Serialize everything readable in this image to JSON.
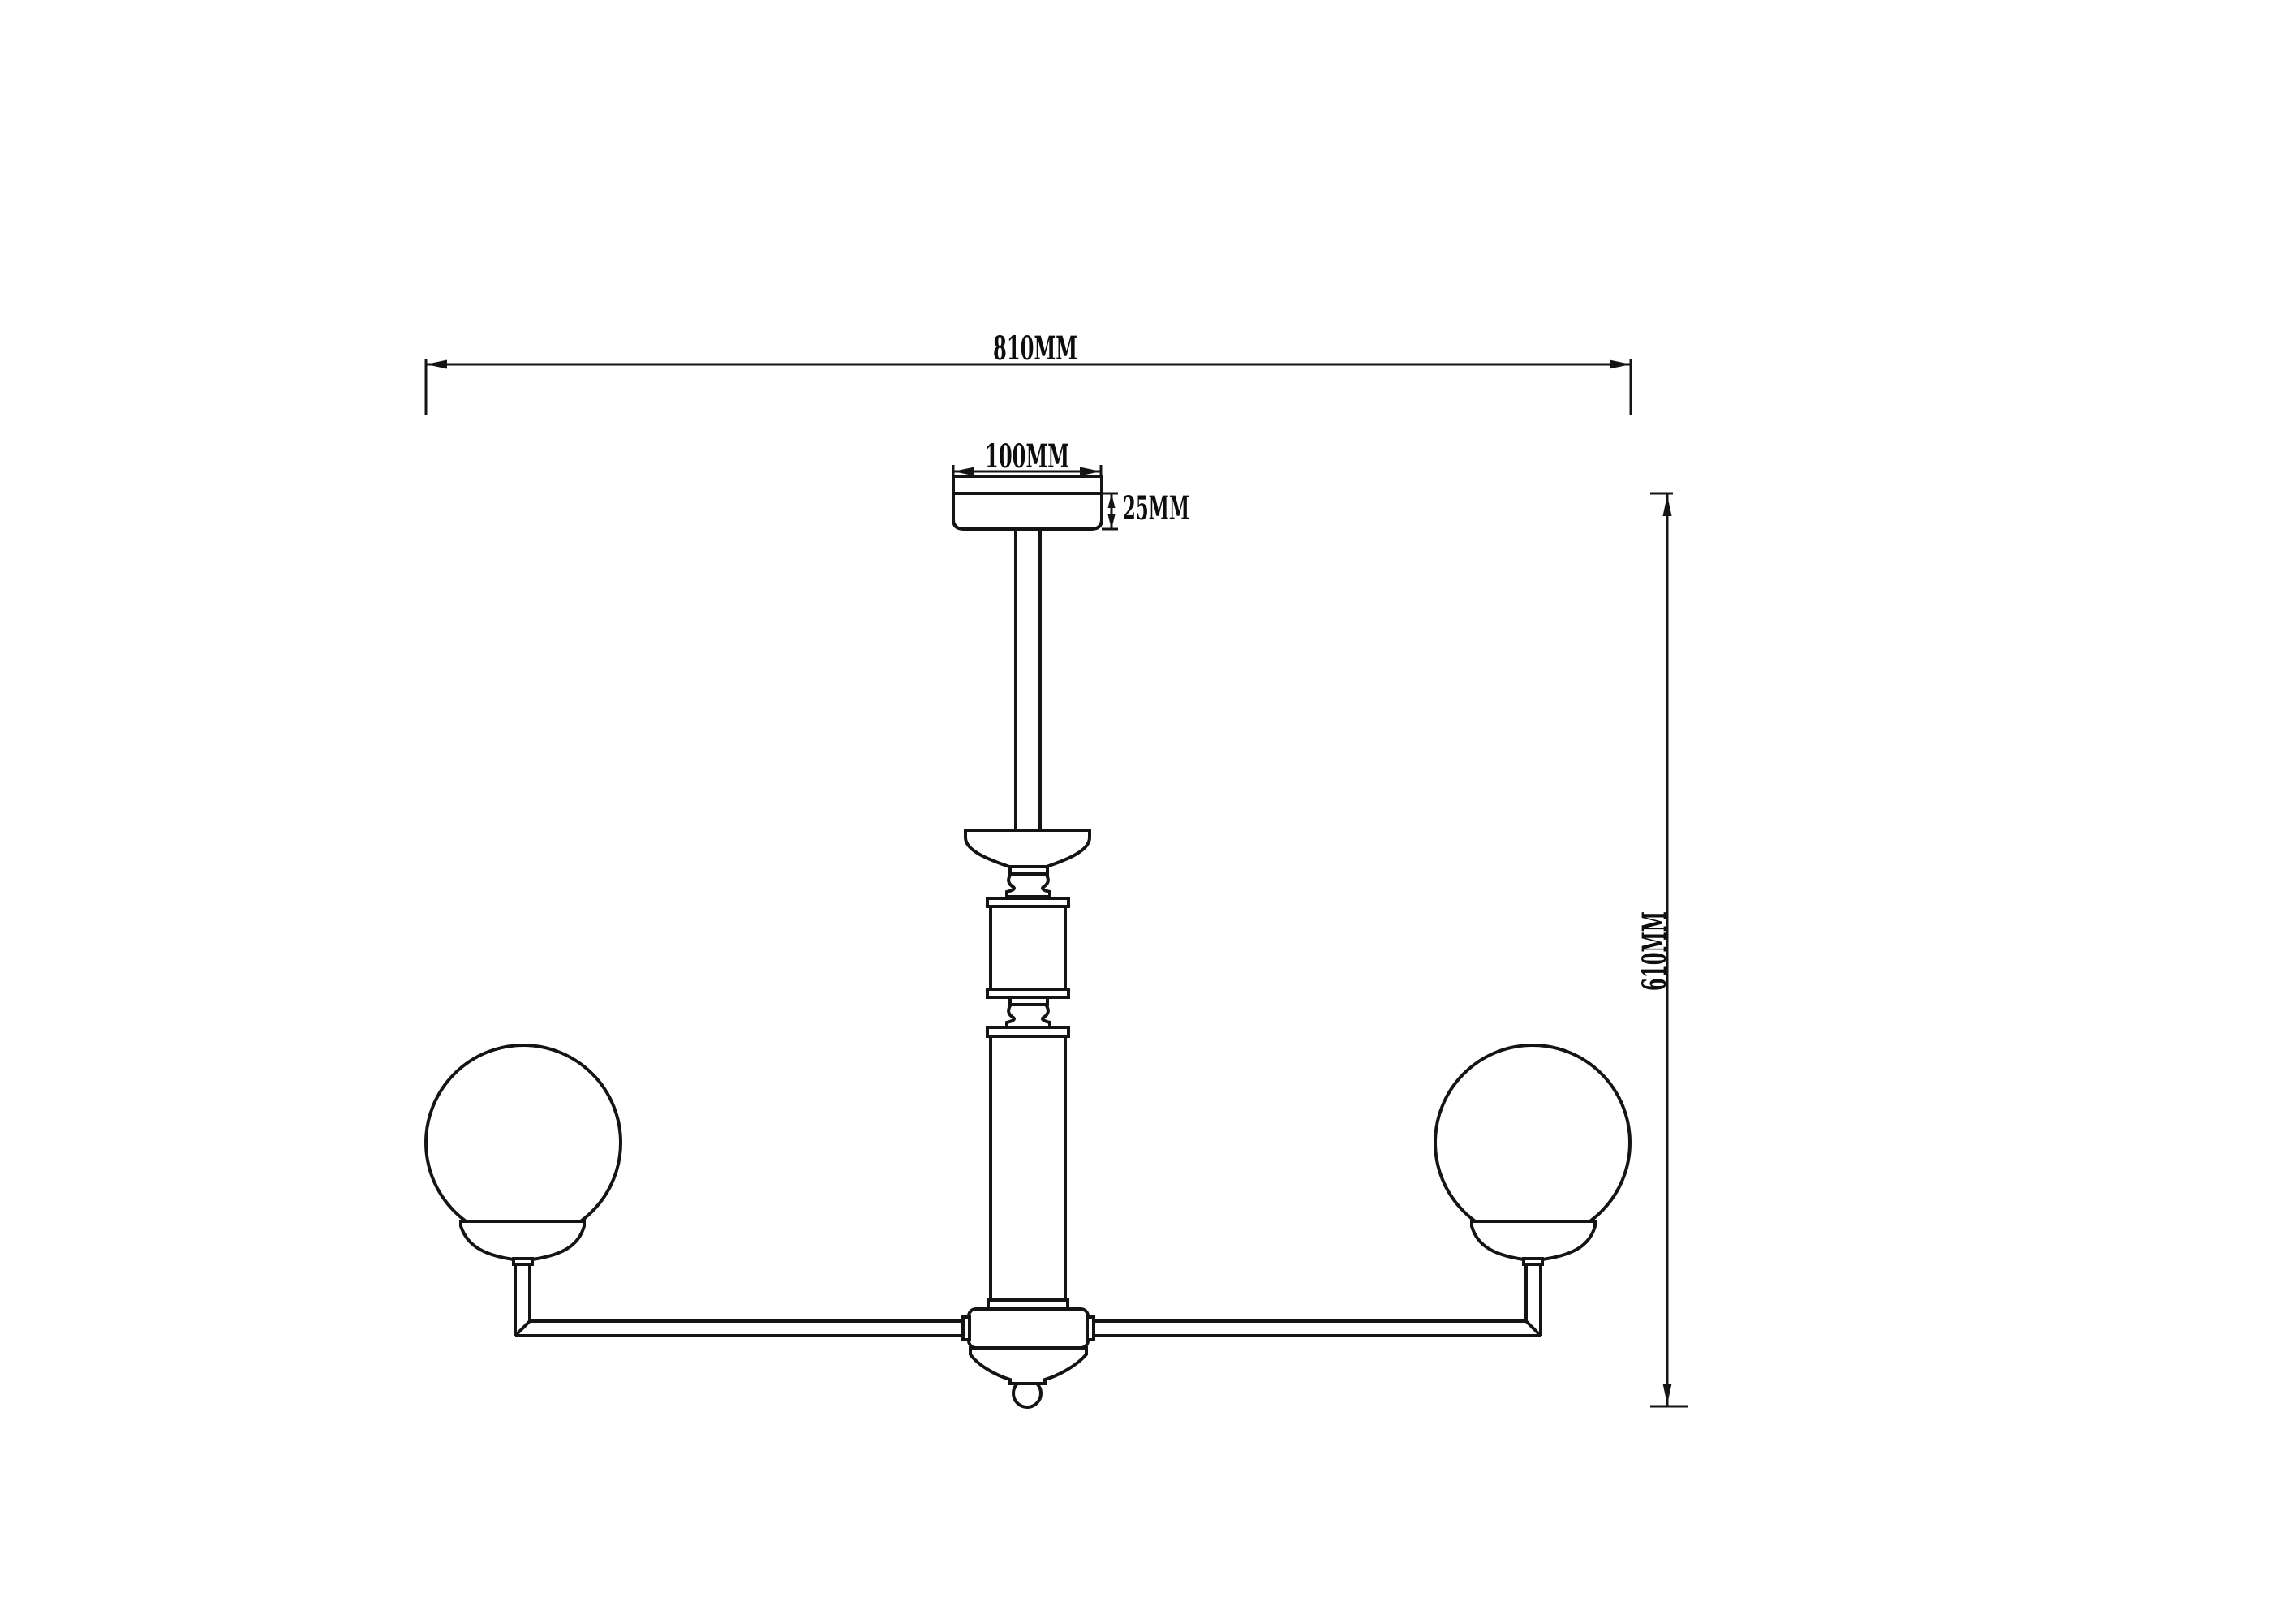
{
  "drawing": {
    "background_color": "#ffffff",
    "line_color": "#141414",
    "labels": {
      "overall_width": "810MM",
      "canopy_width": "100MM",
      "canopy_height": "25MM",
      "overall_height": "610MM"
    },
    "dimensions_mm": {
      "overall_width": 810,
      "canopy_width": 100,
      "canopy_height": 25,
      "overall_height": 610
    }
  }
}
